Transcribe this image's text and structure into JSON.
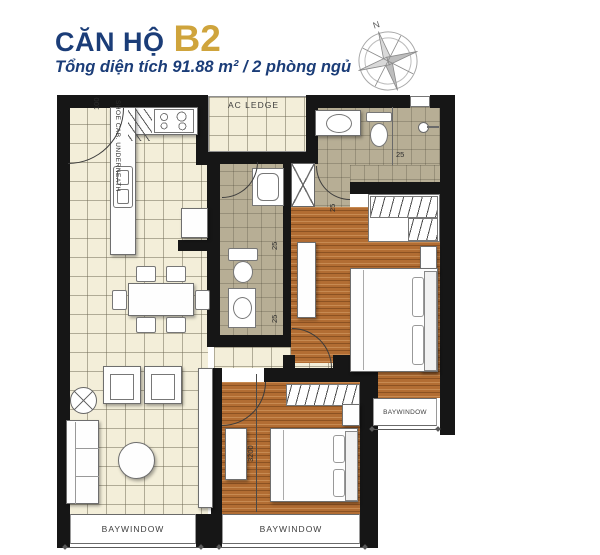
{
  "header": {
    "title_prefix": "CĂN HỘ",
    "title_code": "B2",
    "subtitle": "Tổng diện tích 91.88 m²  /  2 phòng ngủ"
  },
  "compass": {
    "north": "N"
  },
  "plan": {
    "labels": {
      "ac_ledge": "AC LEDGE",
      "shoe_cab": "SHOE CAB. UNDERNEATH",
      "bay_living": "BAYWINDOW",
      "bay_bedroom2": "BAYWINDOW",
      "bay_master": "BAYWINDOW"
    },
    "dims": {
      "entry": "100",
      "bath2_upper": "25",
      "bath2_lower": "25",
      "master_door": "25",
      "master_bath": "25",
      "bedroom2_width": "3200"
    },
    "colors": {
      "accent_navy": "#1b3d78",
      "accent_gold": "#cfa43c",
      "wall": "#161616",
      "tile_cream": "#f3eed9",
      "tile_khaki": "#b7ae95",
      "wood": "#b26d33"
    }
  }
}
